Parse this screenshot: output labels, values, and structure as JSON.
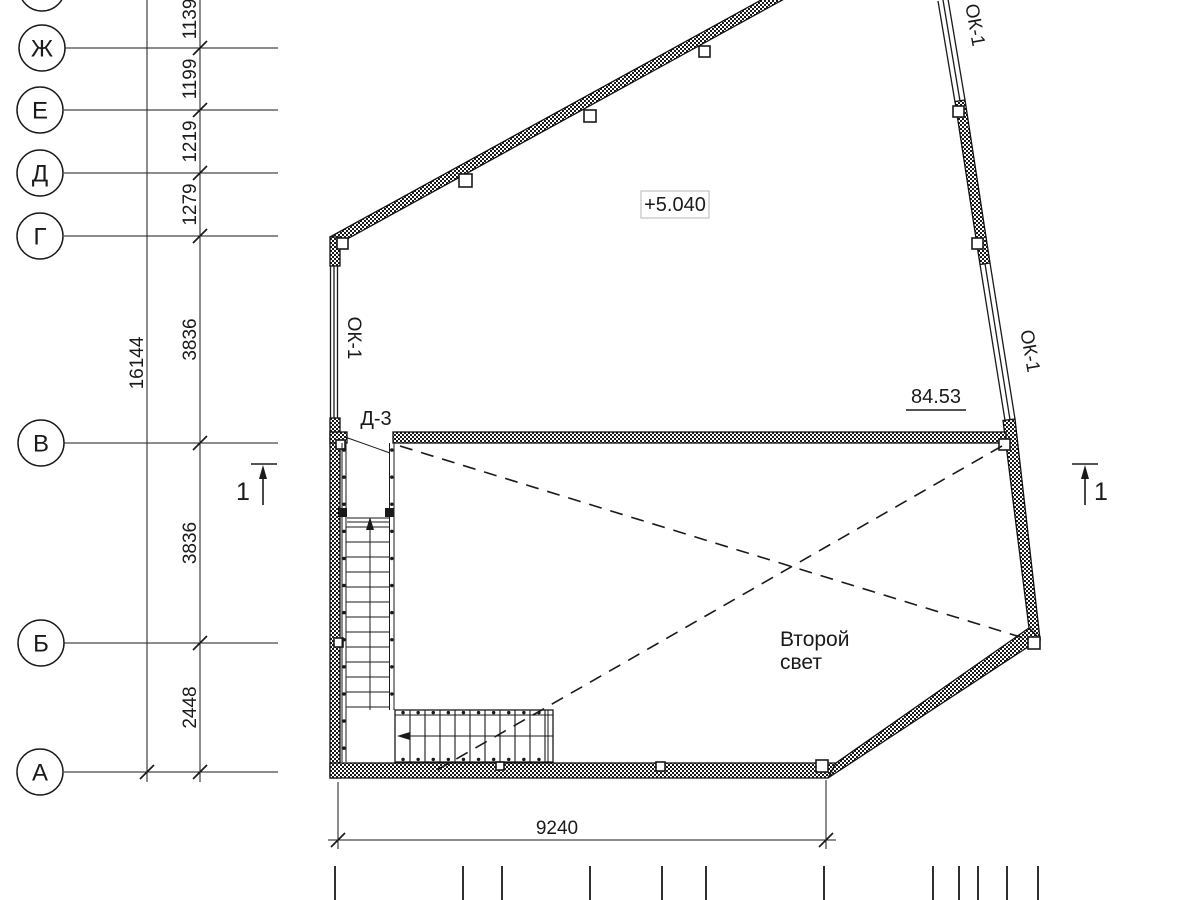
{
  "axes": {
    "labels": [
      "Ж",
      "Е",
      "Д",
      "Г",
      "В",
      "Б",
      "А"
    ]
  },
  "dimensions": {
    "overall_height": "16144",
    "segments": [
      "1139",
      "1199",
      "1219",
      "1279",
      "3836",
      "3836",
      "2448"
    ],
    "bottom_width": "9240"
  },
  "labels": {
    "level_mark": "+5.040",
    "area_mark": "84.53",
    "door": "Д-3",
    "window_left": "ОК-1",
    "window_right_top": "ОК-1",
    "window_right_mid": "ОК-1",
    "void_line1": "Второй",
    "void_line2": "свет"
  },
  "sections": {
    "left": "1",
    "right": "1"
  },
  "colors": {
    "line": "#1a1a1a",
    "background": "#ffffff",
    "level_box_border": "#b5b5b5"
  }
}
